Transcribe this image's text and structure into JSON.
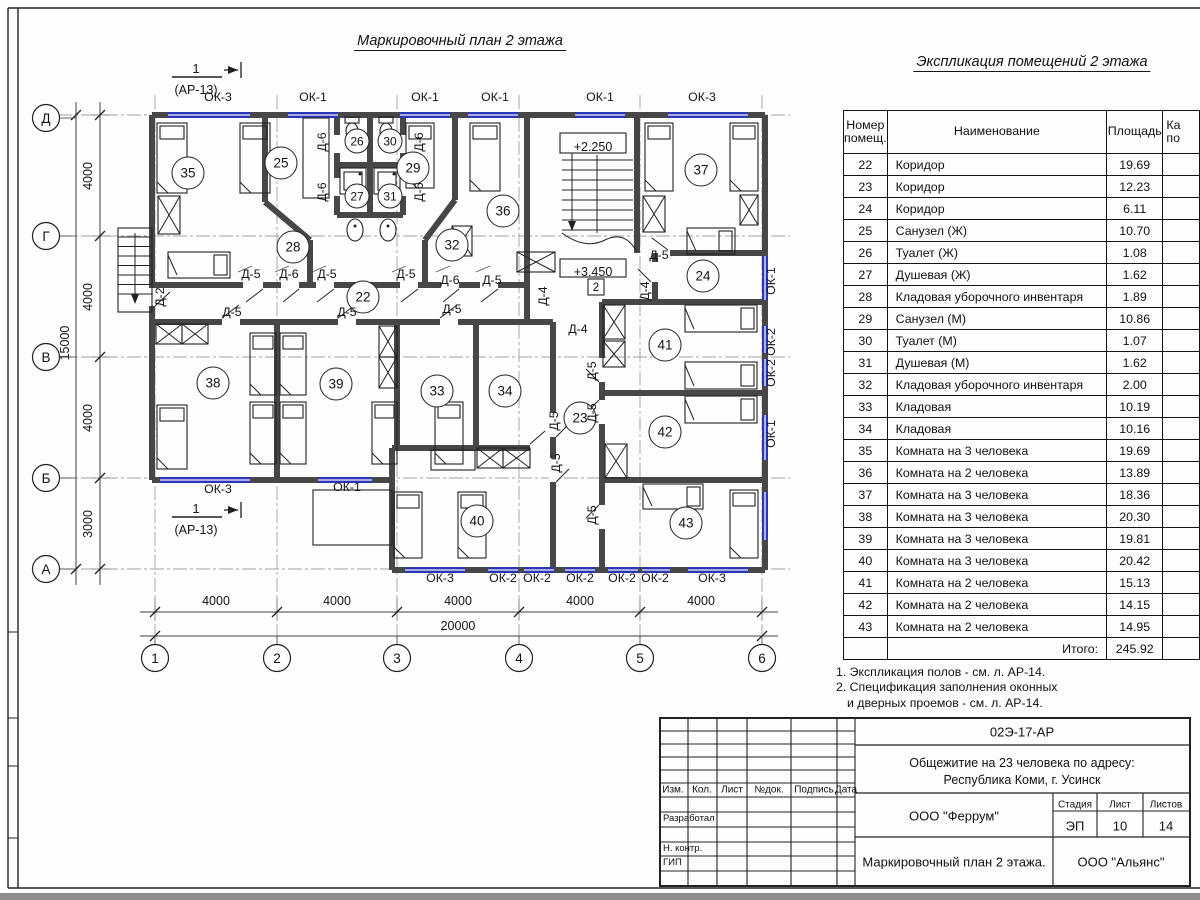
{
  "titles": {
    "plan": "Маркировочный план 2 этажа",
    "table": "Экспликация помещений 2 этажа"
  },
  "notes": [
    "1. Экспликация полов - см. л. АР-14.",
    "2. Спецификация заполнения оконных",
    "и дверных проемов - см. л. АР-14."
  ],
  "table": {
    "col_num_l1": "Номер",
    "col_num_l2": "помещ.",
    "col_name": "Наименование",
    "col_area": "Площадь",
    "col_cat_l1": "Ка",
    "col_cat_l2": "по",
    "rows": [
      [
        "22",
        "Коридор",
        "19.69"
      ],
      [
        "23",
        "Коридор",
        "12.23"
      ],
      [
        "24",
        "Коридор",
        "6.11"
      ],
      [
        "25",
        "Санузел (Ж)",
        "10.70"
      ],
      [
        "26",
        "Туалет (Ж)",
        "1.08"
      ],
      [
        "27",
        "Душевая (Ж)",
        "1.62"
      ],
      [
        "28",
        "Кладовая уборочного инвентаря",
        "1.89"
      ],
      [
        "29",
        "Санузел (М)",
        "10.86"
      ],
      [
        "30",
        "Туалет (М)",
        "1.07"
      ],
      [
        "31",
        "Душевая (М)",
        "1.62"
      ],
      [
        "32",
        "Кладовая уборочного инвентаря",
        "2.00"
      ],
      [
        "33",
        "Кладовая",
        "10.19"
      ],
      [
        "34",
        "Кладовая",
        "10.16"
      ],
      [
        "35",
        "Комната на 3 человека",
        "19.69"
      ],
      [
        "36",
        "Комната на 2 человека",
        "13.89"
      ],
      [
        "37",
        "Комната на 3 человека",
        "18.36"
      ],
      [
        "38",
        "Комната на 3 человека",
        "20.30"
      ],
      [
        "39",
        "Комната на 3 человека",
        "19.81"
      ],
      [
        "40",
        "Комната на 3 человека",
        "20.42"
      ],
      [
        "41",
        "Комната на 2 человека",
        "15.13"
      ],
      [
        "42",
        "Комната на 2 человека",
        "14.15"
      ],
      [
        "43",
        "Комната на 2 человека",
        "14.95"
      ]
    ],
    "total_label": "Итого:",
    "total": "245.92"
  },
  "plan": {
    "rooms": [
      {
        "n": "35",
        "x": 188,
        "y": 173
      },
      {
        "n": "25",
        "x": 281,
        "y": 163
      },
      {
        "n": "26",
        "x": 357,
        "y": 141,
        "s": 1
      },
      {
        "n": "30",
        "x": 390,
        "y": 141,
        "s": 1
      },
      {
        "n": "27",
        "x": 357,
        "y": 196,
        "s": 1
      },
      {
        "n": "31",
        "x": 390,
        "y": 196,
        "s": 1
      },
      {
        "n": "29",
        "x": 413,
        "y": 168
      },
      {
        "n": "36",
        "x": 503,
        "y": 211
      },
      {
        "n": "37",
        "x": 701,
        "y": 170
      },
      {
        "n": "28",
        "x": 293,
        "y": 247
      },
      {
        "n": "32",
        "x": 452,
        "y": 245
      },
      {
        "n": "22",
        "x": 363,
        "y": 297
      },
      {
        "n": "24",
        "x": 703,
        "y": 276
      },
      {
        "n": "38",
        "x": 213,
        "y": 383
      },
      {
        "n": "39",
        "x": 336,
        "y": 384
      },
      {
        "n": "33",
        "x": 437,
        "y": 391
      },
      {
        "n": "34",
        "x": 505,
        "y": 391
      },
      {
        "n": "41",
        "x": 665,
        "y": 345
      },
      {
        "n": "23",
        "x": 580,
        "y": 418
      },
      {
        "n": "42",
        "x": 665,
        "y": 432
      },
      {
        "n": "40",
        "x": 477,
        "y": 521
      },
      {
        "n": "43",
        "x": 686,
        "y": 523
      }
    ],
    "windows": [
      {
        "t": "ОК-3",
        "x": 218,
        "y": 101
      },
      {
        "t": "ОК-1",
        "x": 313,
        "y": 101
      },
      {
        "t": "ОК-1",
        "x": 425,
        "y": 101
      },
      {
        "t": "ОК-1",
        "x": 495,
        "y": 101
      },
      {
        "t": "ОК-1",
        "x": 600,
        "y": 101
      },
      {
        "t": "ОК-3",
        "x": 702,
        "y": 101
      },
      {
        "t": "ОК-3",
        "x": 218,
        "y": 493
      },
      {
        "t": "ОК-1",
        "x": 347,
        "y": 491
      },
      {
        "t": "ОК-3",
        "x": 440,
        "y": 582
      },
      {
        "t": "ОК-2",
        "x": 503,
        "y": 582
      },
      {
        "t": "ОК-2",
        "x": 537,
        "y": 582
      },
      {
        "t": "ОК-2",
        "x": 580,
        "y": 582
      },
      {
        "t": "ОК-2",
        "x": 622,
        "y": 582
      },
      {
        "t": "ОК-2",
        "x": 655,
        "y": 582
      },
      {
        "t": "ОК-3",
        "x": 712,
        "y": 582
      },
      {
        "t": "ОК-1",
        "x": 775,
        "y": 281,
        "r": 1
      },
      {
        "t": "ОК-2",
        "x": 775,
        "y": 342,
        "r": 1
      },
      {
        "t": "ОК-2",
        "x": 775,
        "y": 373,
        "r": 1
      },
      {
        "t": "ОК-1",
        "x": 775,
        "y": 434,
        "r": 1
      }
    ],
    "doors": [
      {
        "t": "Д-5",
        "x": 251,
        "y": 278
      },
      {
        "t": "Д-6",
        "x": 289,
        "y": 278
      },
      {
        "t": "Д-5",
        "x": 327,
        "y": 278
      },
      {
        "t": "Д-5",
        "x": 406,
        "y": 278
      },
      {
        "t": "Д-6",
        "x": 450,
        "y": 284
      },
      {
        "t": "Д-5",
        "x": 492,
        "y": 284
      },
      {
        "t": "Д-5",
        "x": 232,
        "y": 316
      },
      {
        "t": "Д-5",
        "x": 347,
        "y": 316
      },
      {
        "t": "Д-5",
        "x": 452,
        "y": 313
      },
      {
        "t": "Д-4",
        "x": 578,
        "y": 333
      },
      {
        "t": "Д-5",
        "x": 659,
        "y": 259
      },
      {
        "t": "Д-2",
        "x": 164,
        "y": 297,
        "r": 1
      },
      {
        "t": "Д-6",
        "x": 326,
        "y": 142,
        "r": 1
      },
      {
        "t": "Д-6",
        "x": 326,
        "y": 192,
        "r": 1
      },
      {
        "t": "Д-6",
        "x": 423,
        "y": 142,
        "r": 1
      },
      {
        "t": "Д-6",
        "x": 423,
        "y": 192,
        "r": 1
      },
      {
        "t": "Д-4",
        "x": 547,
        "y": 296,
        "r": 1
      },
      {
        "t": "Д-4",
        "x": 649,
        "y": 291,
        "r": 1
      },
      {
        "t": "Д-5",
        "x": 596,
        "y": 371,
        "r": 1
      },
      {
        "t": "Д-5",
        "x": 596,
        "y": 413,
        "r": 1
      },
      {
        "t": "Д-5",
        "x": 558,
        "y": 421,
        "r": 1
      },
      {
        "t": "Д-5",
        "x": 560,
        "y": 463,
        "r": 1
      },
      {
        "t": "Д-5",
        "x": 596,
        "y": 515,
        "r": 1
      }
    ],
    "axes_bottom": [
      {
        "t": "1",
        "x": 155
      },
      {
        "t": "2",
        "x": 277
      },
      {
        "t": "3",
        "x": 397
      },
      {
        "t": "4",
        "x": 519
      },
      {
        "t": "5",
        "x": 640
      },
      {
        "t": "6",
        "x": 762
      }
    ],
    "axes_left": [
      {
        "t": "Д",
        "y": 118
      },
      {
        "t": "Г",
        "y": 236
      },
      {
        "t": "В",
        "y": 357
      },
      {
        "t": "Б",
        "y": 478
      },
      {
        "t": "А",
        "y": 569
      }
    ],
    "dims_bottom": [
      {
        "t": "4000",
        "x": 216
      },
      {
        "t": "4000",
        "x": 337
      },
      {
        "t": "4000",
        "x": 458
      },
      {
        "t": "4000",
        "x": 580
      },
      {
        "t": "4000",
        "x": 701
      }
    ],
    "dim_bottom_total": "20000",
    "dims_left": [
      {
        "t": "4000",
        "y": 176
      },
      {
        "t": "4000",
        "y": 297
      },
      {
        "t": "4000",
        "y": 418
      },
      {
        "t": "3000",
        "y": 524
      }
    ],
    "dim_left_total": "15000",
    "levels": [
      {
        "t": "+2.250",
        "x": 593,
        "y": 147
      },
      {
        "t": "+3.450",
        "x": 593,
        "y": 272
      }
    ],
    "node": "2",
    "section": {
      "num": "1",
      "ref": "(АР-13)"
    }
  },
  "titleblock": {
    "code": "02Э-17-АР",
    "address1": "Общежитие на 23 человека по адресу:",
    "address2": "Республика Коми, г. Усинск",
    "org": "ООО \"Феррум\"",
    "stage_label": "Стадия",
    "sheet_label": "Лист",
    "sheets_label": "Листов",
    "stage": "ЭП",
    "sheet": "10",
    "sheets": "14",
    "doc_name": "Маркировочный план 2 этажа.",
    "org2": "ООО \"Альянс\"",
    "cols": [
      "Изм.",
      "Кол.",
      "Лист",
      "№док.",
      "Подпись",
      "Дата"
    ],
    "roles": [
      "Разработал",
      "Н. контр.",
      "ГИП"
    ]
  }
}
